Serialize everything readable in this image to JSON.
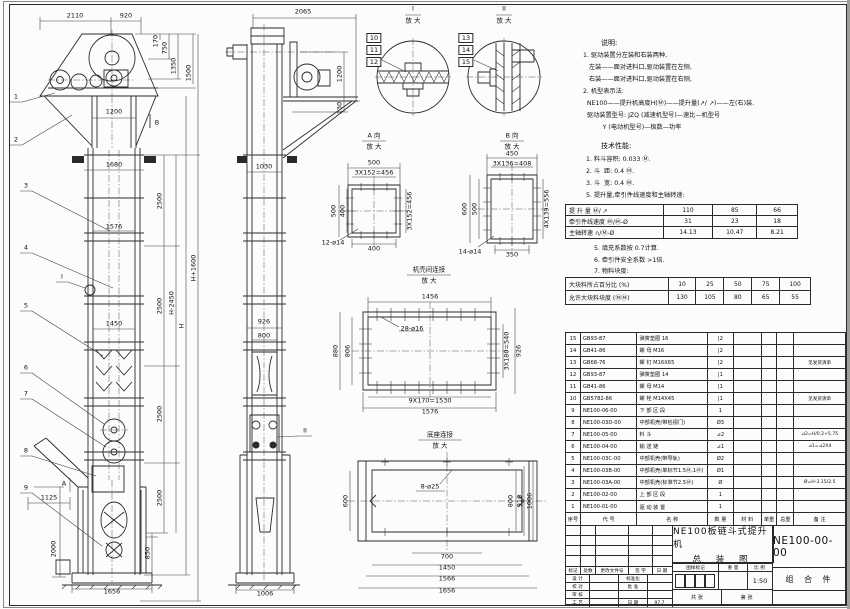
{
  "notes": {
    "title": "说明:",
    "lines": [
      "1. 驱动装置分左装和右装两种,",
      "   左装——面对进料口,驱动装置在左侧,",
      "   右装——面对进料口,驱动装置在右侧,",
      "2. 机型表示法:",
      "  NE100——提升机高度H(Ⓜ)——提升量(↗/ ↗)——左(右)装.",
      "  驱动装置型号: JZQ (减速机型号)—速比—机型号",
      "          Y (电动机型号)—极数—功率"
    ]
  },
  "tech": {
    "title": "技术性能:",
    "lines1": [
      "1. 料斗容积: 0.033 Ⓜ.",
      "2. 斗  距: 0.4 Ⓜ.",
      "3. 斗  宽: 0.4 Ⓜ.",
      "5. 提升量,牵引件线速度和主轴转速:"
    ],
    "lines2": [
      "5. 填充系数按 0.7计算.",
      "6. 牵引件安全系数 >1倍.",
      "7. 物料块度:"
    ]
  },
  "spec1": {
    "rows": [
      [
        "提 升 量   Ⓜ/ ↗",
        "110",
        "85",
        "66"
      ],
      [
        "牵引件线速度  Ⓜ/Ⓜ-Ø",
        "31",
        "23",
        "18"
      ],
      [
        "主轴转速   ∩/Ⓜ-Ø",
        "14.13",
        "10.47",
        "8.21"
      ]
    ]
  },
  "spec2": {
    "rows": [
      [
        "大块料所占百分比 (%)",
        "10",
        "25",
        "50",
        "75",
        "100"
      ],
      [
        "允许大块料块度 (ⓂⓂ)",
        "130",
        "105",
        "80",
        "65",
        "55"
      ]
    ]
  },
  "bom": {
    "header": [
      "序号",
      "代  号",
      "名    称",
      "数 量",
      "材  料",
      "单重",
      "总重",
      "备  注"
    ],
    "rows": [
      [
        "15",
        "GB93-87",
        "弹簧垫圈  16",
        "|2",
        "",
        "",
        "",
        ""
      ],
      [
        "14",
        "GB41-86",
        "螺  母  M16",
        "|2",
        "",
        "",
        "",
        ""
      ],
      [
        "13",
        "GB68-76",
        "螺  钉  M16X65",
        "|2",
        "",
        "",
        "",
        "见发货清单"
      ],
      [
        "12",
        "GB93-87",
        "弹簧垫圈  14",
        "|1",
        "",
        "",
        "",
        ""
      ],
      [
        "11",
        "GB41-86",
        "螺  母  M14",
        "|1",
        "",
        "",
        "",
        ""
      ],
      [
        "10",
        "GB5782-86",
        "螺  栓  M14X45",
        "|1",
        "",
        "",
        "",
        "见发货清单"
      ],
      [
        "9",
        "NE100-06-00",
        "下 部 区 段",
        "1",
        "",
        "",
        "",
        ""
      ],
      [
        "8",
        "NE100-03D-00",
        "中部机壳(带检视门)",
        "Ø3",
        "",
        "",
        "",
        ""
      ],
      [
        "7",
        "NE100-05-00",
        "料  斗",
        "⊿2",
        "",
        "",
        "",
        "⊿2=H/0.2+5.75"
      ],
      [
        "6",
        "NE100-04-00",
        "输 送 链",
        "⊿1",
        "",
        "",
        "",
        "⊿1=⊿2X4"
      ],
      [
        "5",
        "NE100-03C-00",
        "中部机壳(带导轨)",
        "Ø2",
        "",
        "",
        "",
        ""
      ],
      [
        "4",
        "NE100-03B-00",
        "中部机壳(单标节1.5Ⓜ,1Ⓜ)",
        "Ø1",
        "",
        "",
        "",
        ""
      ],
      [
        "3",
        "NE100-03A-00",
        "中部机壳(标准节2.5Ⓜ)",
        "Ø",
        "",
        "",
        "",
        "Ø=H-3.15/2.5"
      ],
      [
        "2",
        "NE100-02-00",
        "上 部 区 段",
        "1",
        "",
        "",
        "",
        ""
      ],
      [
        "1",
        "NE100-01-00",
        "驱 动 装 置",
        "1",
        "",
        "",
        "",
        ""
      ]
    ]
  },
  "titleblock": {
    "title_line1": "NE100板链斗式提升机",
    "title_line2": "总 装 图",
    "drawing_no": "NE100-00-00",
    "part_type": "组 合 件",
    "scale": "1:50",
    "rev_header": [
      "标记",
      "处数",
      "更改文件号",
      "签 字",
      "日 期"
    ],
    "sign_rows": [
      [
        "设 计",
        "",
        "标准化",
        ""
      ],
      [
        "校 对",
        "",
        "批 准",
        ""
      ],
      [
        "审 核",
        "",
        "",
        ""
      ],
      [
        "工 艺",
        "",
        "日 期",
        "97.7"
      ]
    ],
    "stamp_header": [
      "图样标记",
      "重 量",
      "比 例"
    ],
    "sheet_row": [
      "共   张",
      "第   张"
    ]
  },
  "drawing": {
    "labels": [
      [
        "2110",
        75,
        16
      ],
      [
        "920",
        126,
        16
      ],
      [
        "1200",
        114,
        112
      ],
      [
        "170",
        156,
        41,
        1
      ],
      [
        "750",
        165,
        48,
        1
      ],
      [
        "1350",
        174,
        66,
        1
      ],
      [
        "1500",
        189,
        73,
        1
      ],
      [
        "1",
        16,
        97
      ],
      [
        "2",
        16,
        140
      ],
      [
        "3",
        26,
        186
      ],
      [
        "4",
        26,
        248
      ],
      [
        "5",
        26,
        306
      ],
      [
        "6",
        26,
        368
      ],
      [
        "7",
        26,
        394
      ],
      [
        "8",
        26,
        451
      ],
      [
        "9",
        26,
        488
      ],
      [
        "B",
        157,
        123
      ],
      [
        "I",
        62,
        277
      ],
      [
        "A",
        64,
        484
      ],
      [
        "1680",
        114,
        165
      ],
      [
        "1576",
        114,
        227
      ],
      [
        "1450",
        114,
        324
      ],
      [
        "2500",
        160,
        201,
        1
      ],
      [
        "2500",
        160,
        306,
        1
      ],
      [
        "2500",
        160,
        414,
        1
      ],
      [
        "2500",
        160,
        498,
        1
      ],
      [
        "H-2450",
        172,
        303,
        1
      ],
      [
        "H",
        182,
        326,
        1
      ],
      [
        "H+1600",
        194,
        268,
        1
      ],
      [
        "1125",
        49,
        498
      ],
      [
        "2000",
        54,
        549,
        1
      ],
      [
        "850",
        148,
        553,
        1
      ],
      [
        "1656",
        112,
        592
      ],
      [
        "2065",
        303,
        12
      ],
      [
        "1200",
        340,
        74,
        1
      ],
      [
        "130",
        340,
        108,
        1
      ],
      [
        "1030",
        264,
        167
      ],
      [
        "926",
        264,
        322
      ],
      [
        "800",
        264,
        336
      ],
      [
        "II",
        305,
        431
      ],
      [
        "1006",
        265,
        594
      ],
      [
        "I",
        413,
        9
      ],
      [
        "放 大",
        413,
        21
      ],
      [
        "II",
        504,
        9
      ],
      [
        "放 大",
        504,
        21
      ],
      [
        "10",
        374,
        38,
        0,
        "box"
      ],
      [
        "11",
        374,
        50,
        0,
        "box"
      ],
      [
        "12",
        374,
        62,
        0,
        "box"
      ],
      [
        "13",
        466,
        38,
        0,
        "box"
      ],
      [
        "14",
        466,
        50,
        0,
        "box"
      ],
      [
        "15",
        466,
        62,
        0,
        "box"
      ],
      [
        "A 向",
        374,
        136
      ],
      [
        "放 大",
        374,
        147
      ],
      [
        "500",
        374,
        163
      ],
      [
        "3X152=456",
        374,
        173
      ],
      [
        "500",
        334,
        211,
        1
      ],
      [
        "400",
        343,
        211,
        1
      ],
      [
        "3X152=456",
        410,
        211,
        1
      ],
      [
        "400",
        374,
        249
      ],
      [
        "12-ø14",
        333,
        243
      ],
      [
        "B 向",
        512,
        136
      ],
      [
        "放 大",
        512,
        147
      ],
      [
        "450",
        512,
        154
      ],
      [
        "3X136=408",
        512,
        164
      ],
      [
        "600",
        465,
        209,
        1
      ],
      [
        "500",
        475,
        209,
        1
      ],
      [
        "4X139=556",
        547,
        209,
        1
      ],
      [
        "350",
        512,
        255
      ],
      [
        "14-ø14",
        470,
        252
      ],
      [
        "机壳间连接",
        429,
        270
      ],
      [
        "放 大",
        429,
        281
      ],
      [
        "1456",
        430,
        297
      ],
      [
        "28-ø16",
        412,
        329
      ],
      [
        "880",
        336,
        351,
        1
      ],
      [
        "806",
        348,
        351,
        1
      ],
      [
        "3X180=540",
        507,
        351,
        1
      ],
      [
        "926",
        519,
        351,
        1
      ],
      [
        "9X170=1530",
        430,
        401
      ],
      [
        "1576",
        430,
        412
      ],
      [
        "底座连接",
        440,
        435
      ],
      [
        "放 大",
        440,
        446
      ],
      [
        "8-ø25",
        430,
        487
      ],
      [
        "600",
        346,
        501,
        1
      ],
      [
        "800",
        511,
        501,
        1
      ],
      [
        "916",
        520,
        501,
        1
      ],
      [
        "1006",
        530,
        501,
        1
      ],
      [
        "700",
        447,
        557
      ],
      [
        "1450",
        447,
        568
      ],
      [
        "1566",
        447,
        579
      ],
      [
        "1656",
        447,
        591
      ]
    ]
  }
}
